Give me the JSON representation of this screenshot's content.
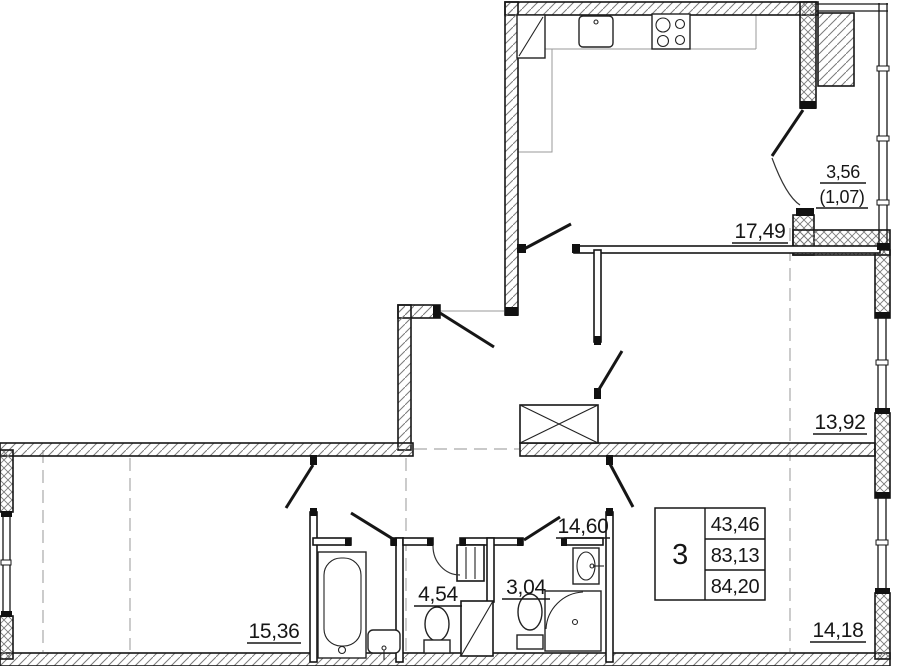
{
  "plan": {
    "rooms": {
      "kitchen_living": "17,49",
      "balcony_area": "3,56",
      "balcony_reduced": "(1,07)",
      "room_right": "13,92",
      "hallway": "14,60",
      "room_left": "15,36",
      "wc": "4,54",
      "shower_room": "3,04",
      "room_bottom": "14,18"
    },
    "info_table": {
      "rooms_count": "3",
      "row1": "43,46",
      "row2": "83,13",
      "row3": "84,20"
    },
    "colors": {
      "line": "#161616",
      "hatch": "#7a7a7a",
      "axis": "#a9a9a9",
      "background": "#ffffff"
    }
  }
}
